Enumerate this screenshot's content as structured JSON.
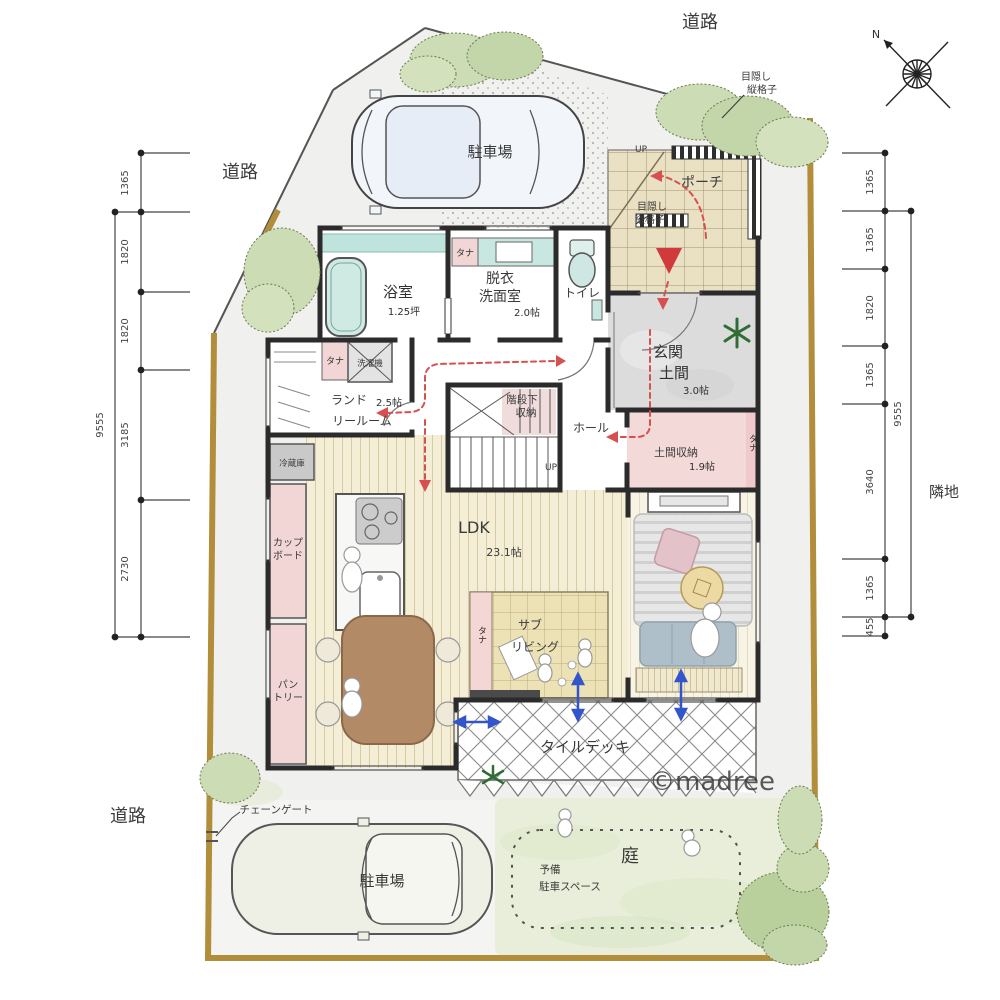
{
  "watermark": "©madree",
  "site": {
    "road_top": "道路",
    "road_upper_left": "道路",
    "road_bottom_left": "道路",
    "neighbor": "隣地",
    "north": "N",
    "chain_gate": "チェーンゲート",
    "lattice_top_1": "目隠し",
    "lattice_top_2": "縦格子",
    "lattice_porch_1": "目隠し",
    "lattice_porch_2": "縦格子"
  },
  "dims": {
    "left": [
      "1365",
      "1820",
      "1820",
      "3185",
      "2730"
    ],
    "left_total": "9555",
    "right": [
      "1365",
      "1365",
      "1820",
      "1365",
      "3640",
      "1365",
      "455"
    ],
    "right_total": "9555"
  },
  "rooms": {
    "parking_top": "駐車場",
    "parking_bottom": "駐車場",
    "bath_name": "浴室",
    "bath_size": "1.25坪",
    "wash_1": "脱衣",
    "wash_2": "洗面室",
    "wash_size": "2.0帖",
    "toilet": "トイレ",
    "porch": "ポーチ",
    "genkan_1": "玄関",
    "genkan_2": "土間",
    "genkan_size": "3.0帖",
    "doma_name": "土間収納",
    "doma_size": "1.9帖",
    "hall": "ホール",
    "stair_1": "階段下",
    "stair_2": "収納",
    "laundry_1": "ランド",
    "laundry_2": "リールーム",
    "laundry_size": "2.5帖",
    "washer": "洗濯機",
    "shelf": "タナ",
    "fridge": "冷蔵庫",
    "cupboard_1": "カップ",
    "cupboard_2": "ボード",
    "pantry_1": "パン",
    "pantry_2": "トリー",
    "ldk": "LDK",
    "ldk_size": "23.1帖",
    "sub_1": "サブ",
    "sub_2": "リビング",
    "deck": "タイルデッキ",
    "garden": "庭",
    "spare_1": "予備",
    "spare_2": "駐車スペース",
    "up": "UP"
  },
  "colors": {
    "fence": "#b28d3a",
    "circulation_red": "#d65050",
    "opening_blue": "#3355cc",
    "water_teal": "#c9e7e1",
    "shelf_pink": "#f2d6d6",
    "wood_cream": "#f5eed7",
    "tatami": "#ece2b6",
    "garden_green": "#e8eeda"
  }
}
